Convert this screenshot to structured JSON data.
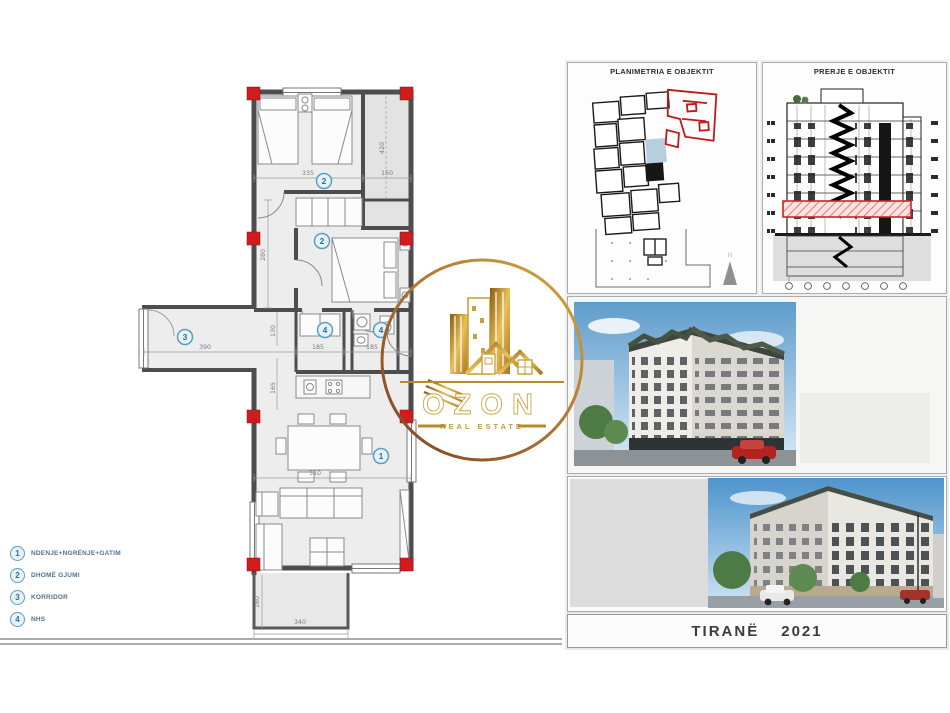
{
  "watermark": {
    "brand": "OZON",
    "tagline": "REAL ESTATE"
  },
  "panels": {
    "site_plan": {
      "title": "PLANIMETRIA E OBJEKTIT",
      "north_label": "N"
    },
    "section": {
      "title": "PRERJE E OBJEKTIT"
    }
  },
  "caption": {
    "city": "TIRANË",
    "year": "2021"
  },
  "legend": {
    "items": [
      {
        "num": "1",
        "label": "NDENJE+NGRËNJE+GATIM"
      },
      {
        "num": "2",
        "label": "DHOMË GJUMI"
      },
      {
        "num": "3",
        "label": "KORRIDOR"
      },
      {
        "num": "4",
        "label": "NHS"
      }
    ]
  },
  "floor_plan": {
    "markers": {
      "living": "1",
      "bedroom_top": "2",
      "bedroom_mid": "2",
      "corridor": "3",
      "bath_a": "4",
      "bath_b": "4"
    },
    "dims": {
      "bedroom_top_width": "335",
      "shaft_width": "150",
      "shaft_height": "420",
      "hall_height": "280",
      "corridor_length": "390",
      "corridor_width": "130",
      "hall_width": "165",
      "bath_a_width": "185",
      "bath_b_width": "185",
      "living_width": "510",
      "balcony_width": "340",
      "balcony_depth": "160"
    }
  },
  "colors": {
    "column_red": "#cf1d1d",
    "wall_gray": "#4d4d4d",
    "marker_blue": "#4f9bbd",
    "gold": "#c9a23a",
    "highlight_red": "#d22222"
  }
}
